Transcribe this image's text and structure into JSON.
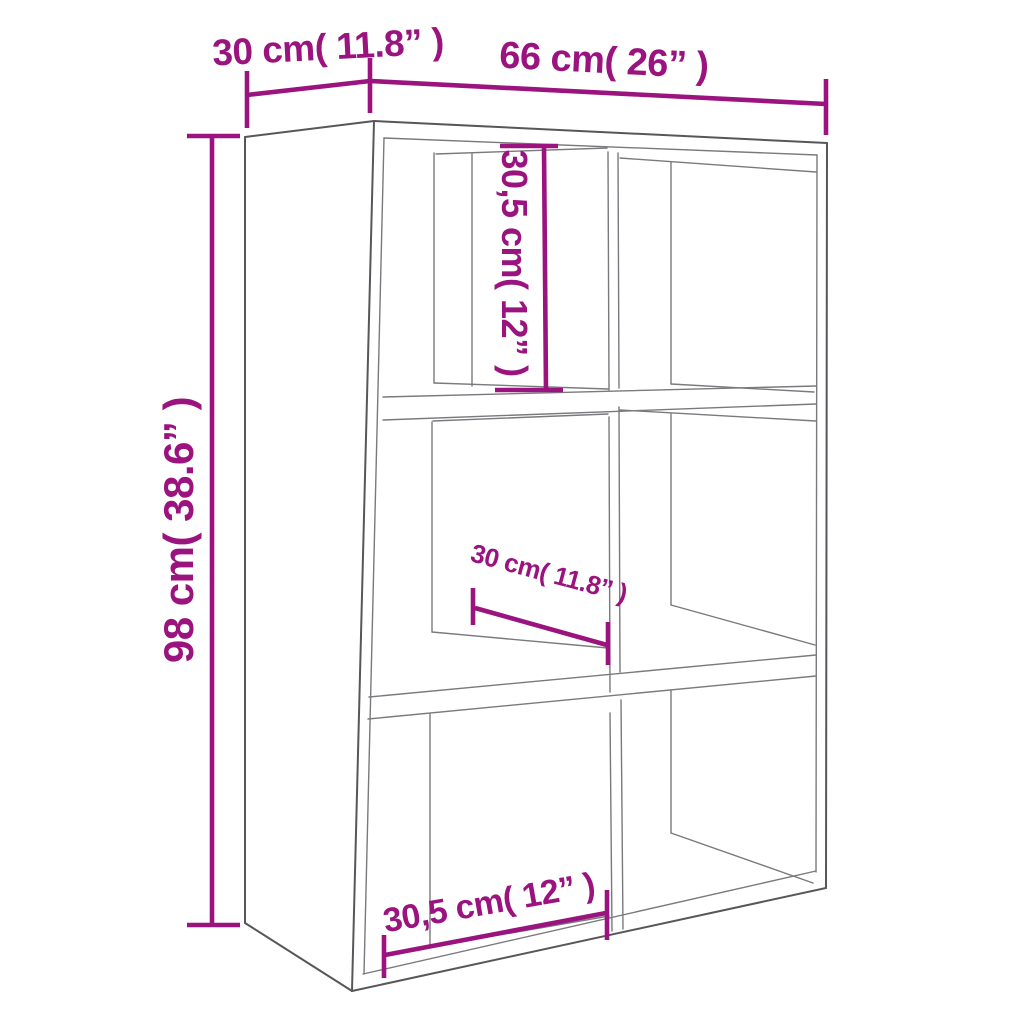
{
  "diagram": {
    "type": "furniture-dimension-diagram",
    "subject": "6-compartment book cabinet / shelving unit, perspective line drawing",
    "colors": {
      "dimension_annotation": "#9a137f",
      "outline_dark": "#57575a",
      "outline_light": "#7a7a7e",
      "background": "#ffffff"
    },
    "dimensions": {
      "depth_top": {
        "label": "30 cm( 11.8” )",
        "value_cm": "30",
        "value_in": "11.8",
        "measures": "overall depth (top left)"
      },
      "width_top": {
        "label": "66 cm( 26” )",
        "value_cm": "66",
        "value_in": "26",
        "measures": "overall width (top)"
      },
      "height_left": {
        "label": "98 cm( 38.6” )",
        "value_cm": "98",
        "value_in": "38.6",
        "measures": "overall height (left side)"
      },
      "compartment_height": {
        "label": "30,5 cm( 12” )",
        "value_cm": "30,5",
        "value_in": "12",
        "measures": "compartment inner height (top middle, vertical)"
      },
      "compartment_depth": {
        "label": "30 cm( 11.8” )",
        "value_cm": "30",
        "value_in": "11.8",
        "measures": "compartment inner depth (middle, diagonal)"
      },
      "compartment_width": {
        "label": "30,5 cm( 12” )",
        "value_cm": "30,5",
        "value_in": "12",
        "measures": "compartment inner width (bottom)"
      }
    }
  }
}
